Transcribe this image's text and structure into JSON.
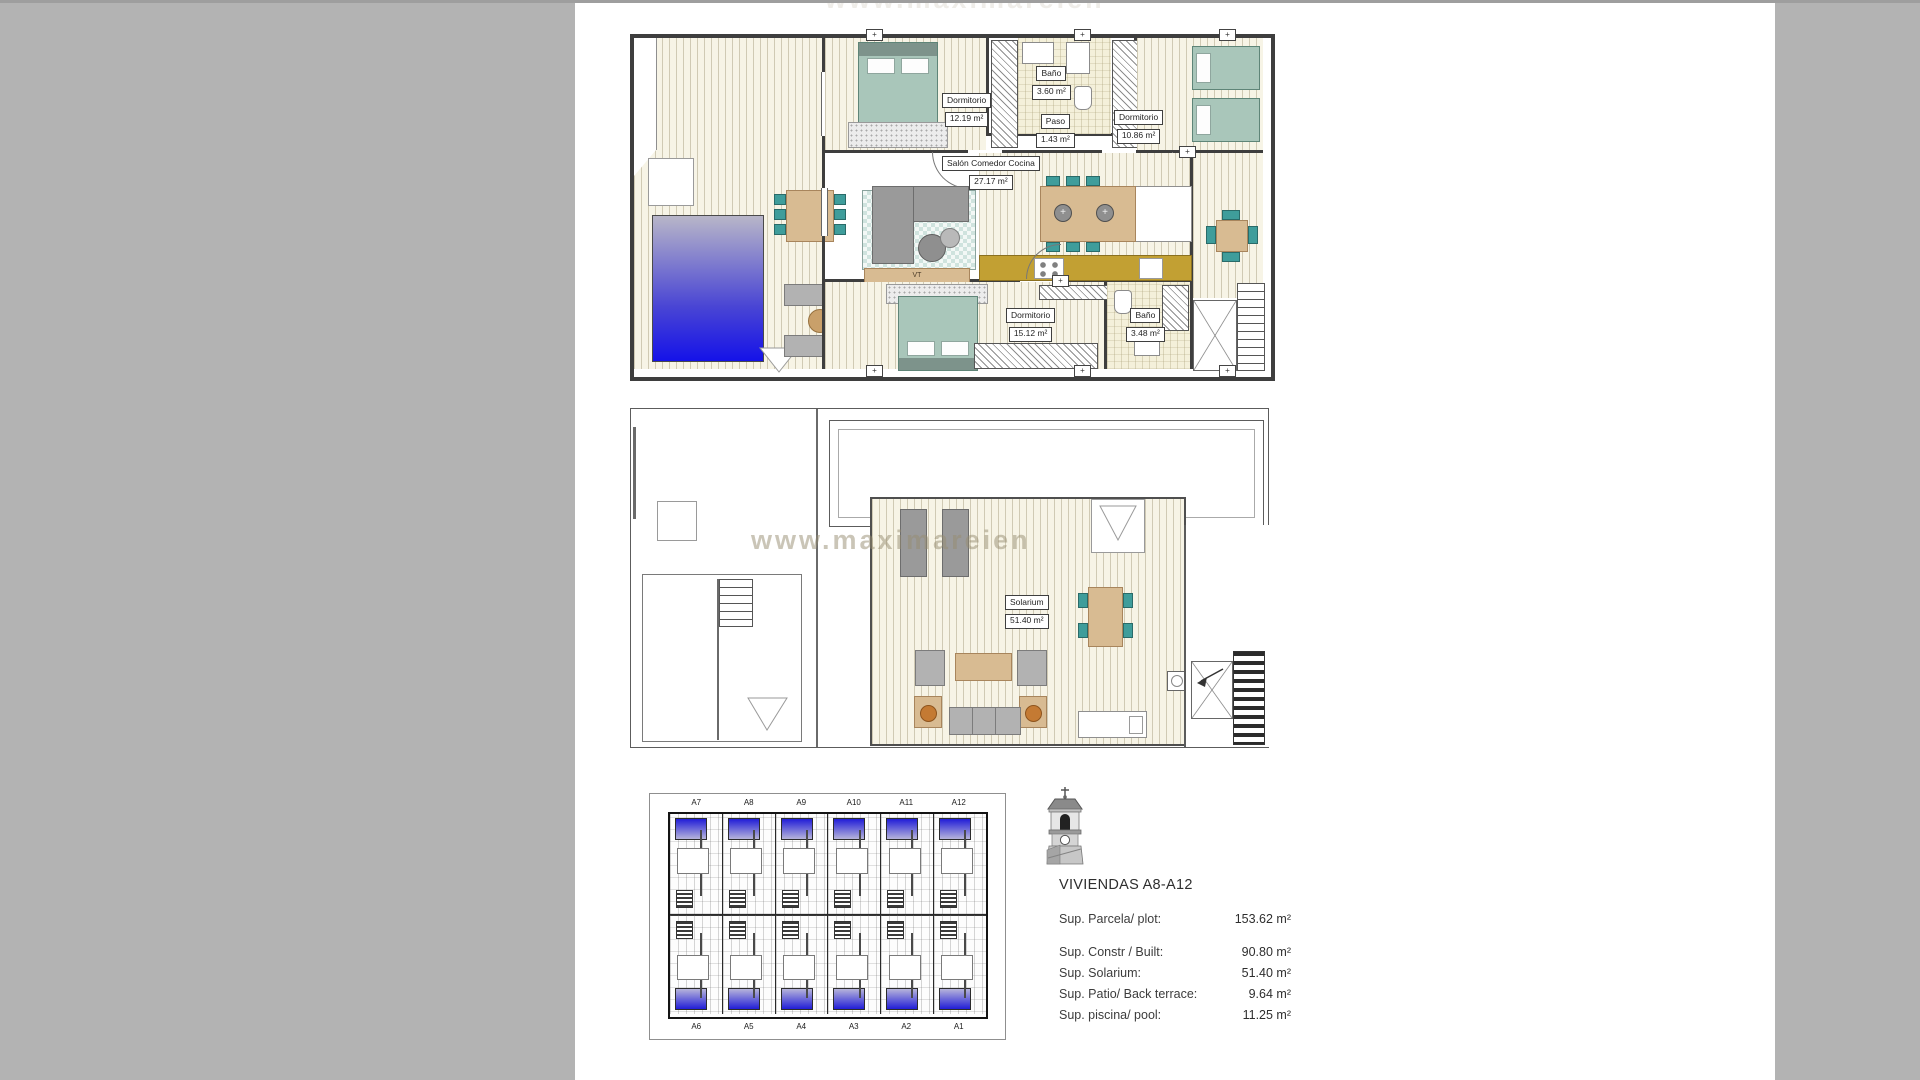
{
  "watermark": {
    "text": "www.maximareien"
  },
  "ground_floor": {
    "rooms": {
      "dormitorio1": {
        "name": "Dormitorio",
        "area": "12.19 m²"
      },
      "bano1": {
        "name": "Baño",
        "area": "3.60 m²"
      },
      "paso": {
        "name": "Paso",
        "area": "1.43 m²"
      },
      "dormitorio2": {
        "name": "Dormitorio",
        "area": "10.86 m²"
      },
      "salon": {
        "name": "Salón Comedor Cocina",
        "area": "27.17 m²"
      },
      "dormitorio3": {
        "name": "Dormitorio",
        "area": "15.12 m²"
      },
      "bano2": {
        "name": "Baño",
        "area": "3.48 m²"
      }
    },
    "tv_label": "VT"
  },
  "solarium_floor": {
    "room": {
      "name": "Solarium",
      "area": "51.40 m²"
    }
  },
  "site_plan": {
    "top_labels": [
      "A7",
      "A8",
      "A9",
      "A10",
      "A11",
      "A12"
    ],
    "bottom_labels": [
      "A6",
      "A5",
      "A4",
      "A3",
      "A2",
      "A1"
    ]
  },
  "info_panel": {
    "title": "VIVIENDAS A8-A12",
    "rows": [
      {
        "label": "Sup. Parcela/ plot:",
        "value": "153.62 m²"
      },
      {
        "label": "Sup. Constr / Built:",
        "value": "90.80 m²"
      },
      {
        "label": "Sup. Solarium:",
        "value": "51.40 m²"
      },
      {
        "label": "Sup. Patio/ Back terrace:",
        "value": "9.64 m²"
      },
      {
        "label": "Sup. piscina/ pool:",
        "value": "11.25 m²"
      }
    ]
  },
  "colors": {
    "page_margin": "#b3b3b3",
    "pool_light": "#b8b6c8",
    "pool_dark": "#1512e8",
    "teal_furniture": "#3f9d9b",
    "tan_furniture": "#d8bb92",
    "kitchen_counter": "#c2a033",
    "bed_teal": "#a9c6ba",
    "watermark_orange": "#c47a33"
  }
}
